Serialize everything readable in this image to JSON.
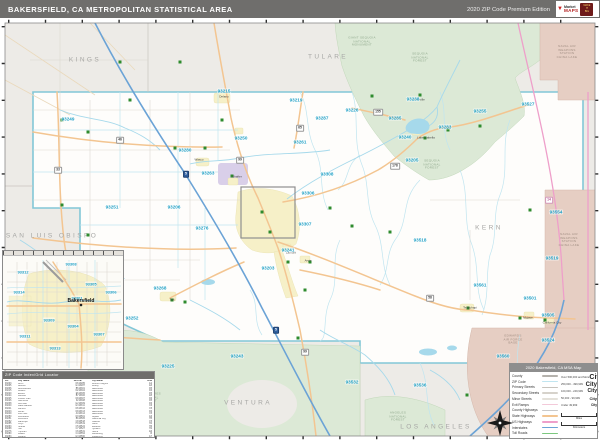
{
  "colors": {
    "header_bg": "#6f6e6c",
    "base": "#edebe7",
    "county_fill": "#fefdfb",
    "county_line": "#82c7d7",
    "zip_line": "#c0e5f0",
    "zip_label": "#1fa0c6",
    "river": "#a6d9eb",
    "interstate": "#6ba3d6",
    "state_hwy": "#f3c591",
    "us_hwy": "#ee9fca",
    "toll": "#7cc87f",
    "exit_ramp": "#f3c9d9",
    "forest": "#dce9d6",
    "military": "#e6cec3",
    "urban": "#f6f0c8",
    "purple_area": "#d9cfe9",
    "county_label": "#a7a7a5",
    "town_marker": "#2e8b2e"
  },
  "header": {
    "title": "BAKERSFIELD, CA METROPOLITAN STATISTICAL AREA",
    "edition": "2020 ZIP Code Premium Edition",
    "logo_market": "Market",
    "logo_maps": "MAPS",
    "logo_badge": "MAKE\nIT\nBIG",
    "logo_pin": "▼"
  },
  "map": {
    "county_labels": [
      {
        "text": "KINGS",
        "x": 85,
        "y": 60
      },
      {
        "text": "TULARE",
        "x": 328,
        "y": 57
      },
      {
        "text": "KERN",
        "x": 489,
        "y": 228
      },
      {
        "text": "SAN LUIS OBISPO",
        "x": 52,
        "y": 236
      },
      {
        "text": "SANTA BARBARA",
        "x": 103,
        "y": 387
      },
      {
        "text": "VENTURA",
        "x": 248,
        "y": 403
      },
      {
        "text": "LOS ANGELES",
        "x": 436,
        "y": 427
      }
    ],
    "area_labels": [
      {
        "text": "GIANT SEQUOIA\nNATIONAL\nMONUMENT",
        "x": 362,
        "y": 42,
        "kind": "forest"
      },
      {
        "text": "SEQUOIA\nNATIONAL\nFOREST",
        "x": 420,
        "y": 58,
        "kind": "forest"
      },
      {
        "text": "SEQUOIA\nNATIONAL\nFOREST",
        "x": 432,
        "y": 165,
        "kind": "forest"
      },
      {
        "text": "LOS PADRES\nNATIONAL\nFOREST",
        "x": 150,
        "y": 398,
        "kind": "forest"
      },
      {
        "text": "ANGELES\nNATIONAL\nFOREST",
        "x": 398,
        "y": 417,
        "kind": "forest"
      },
      {
        "text": "NAVAL AIR\nWEAPONS\nSTATION\nCHINA LAKE",
        "x": 567,
        "y": 52,
        "kind": "military"
      },
      {
        "text": "NAVAL AIR\nWEAPONS\nSTATION\nCHINA LAKE",
        "x": 569,
        "y": 240,
        "kind": "military"
      },
      {
        "text": "EDWARDS\nAIR FORCE\nBASE",
        "x": 513,
        "y": 340,
        "kind": "military"
      }
    ],
    "zip_labels": [
      {
        "code": "93249",
        "x": 68,
        "y": 119
      },
      {
        "code": "93251",
        "x": 112,
        "y": 207
      },
      {
        "code": "93206",
        "x": 174,
        "y": 207
      },
      {
        "code": "93215",
        "x": 224,
        "y": 91
      },
      {
        "code": "93219",
        "x": 296,
        "y": 100
      },
      {
        "code": "93261",
        "x": 300,
        "y": 142
      },
      {
        "code": "93250",
        "x": 241,
        "y": 138
      },
      {
        "code": "93280",
        "x": 185,
        "y": 150
      },
      {
        "code": "93263",
        "x": 208,
        "y": 173
      },
      {
        "code": "93276",
        "x": 202,
        "y": 228
      },
      {
        "code": "93308",
        "x": 327,
        "y": 174
      },
      {
        "code": "93306",
        "x": 308,
        "y": 193
      },
      {
        "code": "93307",
        "x": 305,
        "y": 224
      },
      {
        "code": "93241",
        "x": 288,
        "y": 250
      },
      {
        "code": "93203",
        "x": 268,
        "y": 268
      },
      {
        "code": "93287",
        "x": 322,
        "y": 118
      },
      {
        "code": "93226",
        "x": 352,
        "y": 110
      },
      {
        "code": "93285",
        "x": 395,
        "y": 118
      },
      {
        "code": "93238",
        "x": 413,
        "y": 99
      },
      {
        "code": "93240",
        "x": 405,
        "y": 137
      },
      {
        "code": "93283",
        "x": 445,
        "y": 127
      },
      {
        "code": "93255",
        "x": 480,
        "y": 111
      },
      {
        "code": "93527",
        "x": 528,
        "y": 104
      },
      {
        "code": "93554",
        "x": 556,
        "y": 212
      },
      {
        "code": "93205",
        "x": 412,
        "y": 160
      },
      {
        "code": "93518",
        "x": 420,
        "y": 240
      },
      {
        "code": "93561",
        "x": 480,
        "y": 285
      },
      {
        "code": "93501",
        "x": 530,
        "y": 298
      },
      {
        "code": "93505",
        "x": 548,
        "y": 315
      },
      {
        "code": "93519",
        "x": 552,
        "y": 258
      },
      {
        "code": "93524",
        "x": 548,
        "y": 340
      },
      {
        "code": "93560",
        "x": 503,
        "y": 356
      },
      {
        "code": "93536",
        "x": 420,
        "y": 385
      },
      {
        "code": "93532",
        "x": 352,
        "y": 382
      },
      {
        "code": "93243",
        "x": 237,
        "y": 356
      },
      {
        "code": "93225",
        "x": 168,
        "y": 366
      },
      {
        "code": "93252",
        "x": 132,
        "y": 318
      },
      {
        "code": "93268",
        "x": 160,
        "y": 288
      },
      {
        "code": "93224",
        "x": 118,
        "y": 278
      }
    ],
    "town_labels": [
      {
        "text": "Delano",
        "x": 224,
        "y": 100
      },
      {
        "text": "Wasco",
        "x": 199,
        "y": 163
      },
      {
        "text": "Shafter",
        "x": 237,
        "y": 180
      },
      {
        "text": "Taft",
        "x": 172,
        "y": 303
      },
      {
        "text": "Tehachapi",
        "x": 470,
        "y": 311
      },
      {
        "text": "Mojave",
        "x": 528,
        "y": 321
      },
      {
        "text": "California City",
        "x": 552,
        "y": 326
      },
      {
        "text": "Arvin",
        "x": 308,
        "y": 264
      },
      {
        "text": "Lamont",
        "x": 291,
        "y": 256
      },
      {
        "text": "Lake Isabella",
        "x": 426,
        "y": 141
      },
      {
        "text": "Kernville",
        "x": 419,
        "y": 103
      }
    ],
    "route_shields": [
      {
        "num": "5",
        "kind": "interstate",
        "x": 186,
        "y": 174
      },
      {
        "num": "5",
        "kind": "interstate",
        "x": 276,
        "y": 330
      },
      {
        "num": "99",
        "kind": "state",
        "x": 240,
        "y": 160
      },
      {
        "num": "99",
        "kind": "state",
        "x": 305,
        "y": 352
      },
      {
        "num": "58",
        "kind": "state",
        "x": 430,
        "y": 298
      },
      {
        "num": "46",
        "kind": "state",
        "x": 120,
        "y": 140
      },
      {
        "num": "178",
        "kind": "state",
        "x": 395,
        "y": 166
      },
      {
        "num": "65",
        "kind": "state",
        "x": 300,
        "y": 128
      },
      {
        "num": "166",
        "kind": "state",
        "x": 100,
        "y": 328
      },
      {
        "num": "14",
        "kind": "us",
        "x": 549,
        "y": 200
      },
      {
        "num": "33",
        "kind": "state",
        "x": 58,
        "y": 170
      },
      {
        "num": "155",
        "kind": "state",
        "x": 378,
        "y": 112
      }
    ],
    "town_markers": [
      [
        130,
        100
      ],
      [
        222,
        120
      ],
      [
        205,
        148
      ],
      [
        175,
        148
      ],
      [
        62,
        120
      ],
      [
        88,
        132
      ],
      [
        232,
        176
      ],
      [
        262,
        212
      ],
      [
        270,
        232
      ],
      [
        288,
        262
      ],
      [
        305,
        290
      ],
      [
        330,
        208
      ],
      [
        352,
        226
      ],
      [
        390,
        232
      ],
      [
        425,
        138
      ],
      [
        448,
        130
      ],
      [
        480,
        126
      ],
      [
        468,
        308
      ],
      [
        520,
        318
      ],
      [
        545,
        320
      ],
      [
        172,
        300
      ],
      [
        185,
        302
      ],
      [
        310,
        262
      ],
      [
        298,
        338
      ],
      [
        467,
        395
      ],
      [
        530,
        210
      ],
      [
        120,
        62
      ],
      [
        180,
        62
      ],
      [
        420,
        95
      ],
      [
        372,
        96
      ],
      [
        62,
        205
      ],
      [
        88,
        235
      ]
    ]
  },
  "inset": {
    "city_label": "Bakersfield",
    "zip_labels": [
      {
        "code": "93308",
        "x": 68,
        "y": 8
      },
      {
        "code": "93312",
        "x": 20,
        "y": 16
      },
      {
        "code": "93314",
        "x": 16,
        "y": 36
      },
      {
        "code": "93305",
        "x": 88,
        "y": 28
      },
      {
        "code": "93306",
        "x": 108,
        "y": 36
      },
      {
        "code": "93301",
        "x": 74,
        "y": 42
      },
      {
        "code": "93309",
        "x": 46,
        "y": 64
      },
      {
        "code": "93304",
        "x": 70,
        "y": 70
      },
      {
        "code": "93311",
        "x": 22,
        "y": 80
      },
      {
        "code": "93313",
        "x": 52,
        "y": 92
      },
      {
        "code": "93307",
        "x": 96,
        "y": 78
      }
    ]
  },
  "index_table": {
    "title": "ZIP Code Index/Grid Locator",
    "columns": [
      "ZIP",
      "City Name",
      "Grid"
    ],
    "rows": [
      [
        "93203",
        "Arvin",
        "D6"
      ],
      [
        "93205",
        "Bodfish",
        "G4"
      ],
      [
        "93206",
        "Buttonwillow",
        "B5"
      ],
      [
        "93215",
        "Delano",
        "D2"
      ],
      [
        "93220",
        "Edison",
        "E6"
      ],
      [
        "93224",
        "Fellows",
        "B7"
      ],
      [
        "93225",
        "Frazier Park",
        "D9"
      ],
      [
        "93226",
        "Glennville",
        "F2"
      ],
      [
        "93238",
        "Kernville",
        "G2"
      ],
      [
        "93240",
        "Lake Isabella",
        "G3"
      ],
      [
        "93241",
        "Lamont",
        "D6"
      ],
      [
        "93243",
        "Lebec",
        "D9"
      ],
      [
        "93249",
        "Lost Hills",
        "A3"
      ],
      [
        "93250",
        "McFarland",
        "D3"
      ],
      [
        "93251",
        "McKittrick",
        "B6"
      ],
      [
        "93252",
        "Maricopa",
        "C8"
      ],
      [
        "93255",
        "Onyx",
        "H3"
      ],
      [
        "93263",
        "Shafter",
        "C5"
      ],
      [
        "93268",
        "Taft",
        "C7"
      ],
      [
        "93276",
        "Tupman",
        "C6"
      ],
      [
        "93280",
        "Wasco",
        "C4"
      ],
      [
        "93283",
        "Weldon",
        "G3"
      ],
      [
        "93285",
        "Wofford Heights",
        "G2"
      ],
      [
        "93287",
        "Woody",
        "E3"
      ],
      [
        "93301",
        "Bakersfield",
        "D5"
      ],
      [
        "93304",
        "Bakersfield",
        "D6"
      ],
      [
        "93305",
        "Bakersfield",
        "D5"
      ],
      [
        "93306",
        "Bakersfield",
        "E5"
      ],
      [
        "93307",
        "Bakersfield",
        "D6"
      ],
      [
        "93308",
        "Bakersfield",
        "D5"
      ],
      [
        "93309",
        "Bakersfield",
        "D6"
      ],
      [
        "93311",
        "Bakersfield",
        "C6"
      ],
      [
        "93312",
        "Bakersfield",
        "C5"
      ],
      [
        "93313",
        "Bakersfield",
        "D6"
      ],
      [
        "93314",
        "Bakersfield",
        "C5"
      ],
      [
        "93501",
        "Mojave",
        "G6"
      ],
      [
        "93505",
        "California City",
        "H5"
      ],
      [
        "93518",
        "Caliente",
        "F5"
      ],
      [
        "93519",
        "Cantil",
        "H4"
      ],
      [
        "93524",
        "Edwards",
        "H6"
      ],
      [
        "93527",
        "Inyokern",
        "H2"
      ],
      [
        "93531",
        "Keene",
        "E6"
      ],
      [
        "93554",
        "Randsburg",
        "I3"
      ],
      [
        "93560",
        "Rosamond",
        "G7"
      ]
    ]
  },
  "legend": {
    "title": "2020 Bakersfield, CA MSA Map",
    "road_items": [
      {
        "label": "County",
        "cls": "sw-county"
      },
      {
        "label": "ZIP Code",
        "cls": "sw-zip"
      },
      {
        "label": "Primary Streets",
        "cls": "sw-primary"
      },
      {
        "label": "Secondary Streets",
        "cls": "sw-secondary"
      },
      {
        "label": "Minor Streets",
        "cls": "sw-minor"
      },
      {
        "label": "Exit Ramps",
        "cls": "sw-exit"
      },
      {
        "label": "County Highways",
        "cls": "sw-countyhwy"
      },
      {
        "label": "State Highways",
        "cls": "sw-statehwy"
      },
      {
        "label": "US Highways",
        "cls": "sw-ushwy"
      },
      {
        "label": "Interstates",
        "cls": "sw-interstate"
      },
      {
        "label": "Toll Roads",
        "cls": "sw-toll"
      }
    ],
    "city_classes": [
      {
        "range": "Over 500,000 and More",
        "sample": "City",
        "px": 7
      },
      {
        "range": "250,000 - 499,999",
        "sample": "City",
        "px": 6
      },
      {
        "range": "100,000 - 249,999",
        "sample": "City",
        "px": 5
      },
      {
        "range": "50,000 - 99,999",
        "sample": "City",
        "px": 4
      },
      {
        "range": "Under 49,999",
        "sample": "City",
        "px": 3.2
      }
    ],
    "scale": {
      "miles": "Miles",
      "kilometers": "Kilometers"
    }
  }
}
